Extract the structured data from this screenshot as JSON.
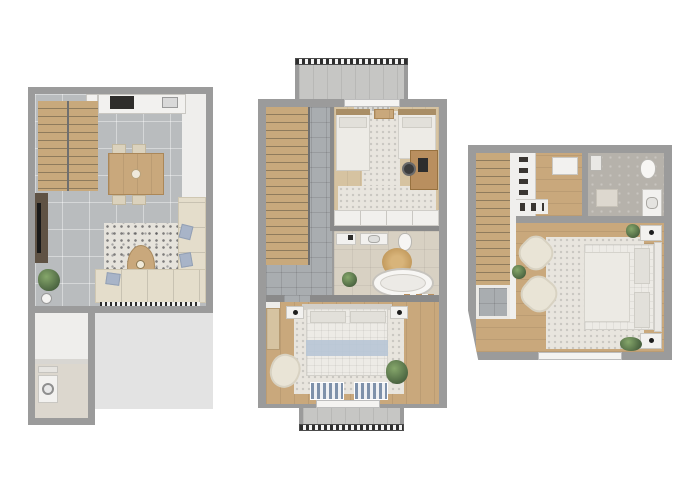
{
  "document": {
    "type": "architectural-floor-plans",
    "plan_count": 3,
    "background": "#ffffff",
    "visible_text": ""
  },
  "palette": {
    "bg": "#ffffff",
    "wall": "#9b9b9b",
    "innerWall": "#f0efed",
    "tile": "#b9bcbe",
    "tileDark": "#a9adb0",
    "wood": "#c9a87c",
    "woodLight": "#d6c3a1",
    "stairs": "#c8a97c",
    "stepLine": "#8e7b5c",
    "rug": "#e8e5de",
    "sofa": "#e4ddcb",
    "pillowBlue": "#a8b4c8",
    "blanketBlue": "#b7c5d5",
    "bathFloor": "#d8d1c3",
    "stoneFloor": "#b6b2ab",
    "patio": "#e3e3e3",
    "railDark": "#2e2e2e",
    "deskWood": "#b98f5f",
    "plantGreen": "#4c6a3f"
  },
  "plans": [
    {
      "name": "ground-floor",
      "rooms": [
        "staircase",
        "kitchen",
        "dining-area",
        "living-room",
        "entry-hall",
        "utility-room",
        "patio"
      ],
      "furniture": [
        "kitchen-counter",
        "cooktop",
        "kitchen-sink",
        "dining-table",
        "dining-chairs",
        "living-rug",
        "coffee-table",
        "corner-sofa",
        "tv-unit",
        "plant",
        "toilet-paper-stand",
        "washing-machine"
      ]
    },
    {
      "name": "middle-floor",
      "rooms": [
        "staircase",
        "hallway",
        "kids-bedroom",
        "bathroom",
        "bedroom",
        "balcony-top",
        "balcony-bottom"
      ],
      "furniture": [
        "twin-bed-left",
        "twin-bed-right",
        "between-beds-table",
        "desk",
        "desk-chair",
        "wardrobe-band",
        "vanity",
        "bath-sink",
        "toilet",
        "jute-rug",
        "bathtub",
        "bath-bench",
        "bath-plant",
        "double-bed",
        "nightstand-left",
        "nightstand-right",
        "wardrobe-panel",
        "armchair",
        "bedroom-plant",
        "striped-mat-left",
        "striped-mat-right"
      ]
    },
    {
      "name": "top-floor",
      "rooms": [
        "staircase",
        "stair-landing",
        "walk-in-closet",
        "bathroom",
        "master-bedroom"
      ],
      "furniture": [
        "clothes-rack-vertical",
        "clothes-rack-horizontal",
        "dresser",
        "shower-tray",
        "toilet",
        "sink-vanity",
        "bath-mat",
        "double-bed",
        "headboard",
        "pillows",
        "nightstand-top",
        "nightstand-bottom",
        "armchair-upper",
        "armchair-lower",
        "plant-left",
        "plant-top-right",
        "plant-bottom-right",
        "bedroom-rug"
      ]
    }
  ]
}
